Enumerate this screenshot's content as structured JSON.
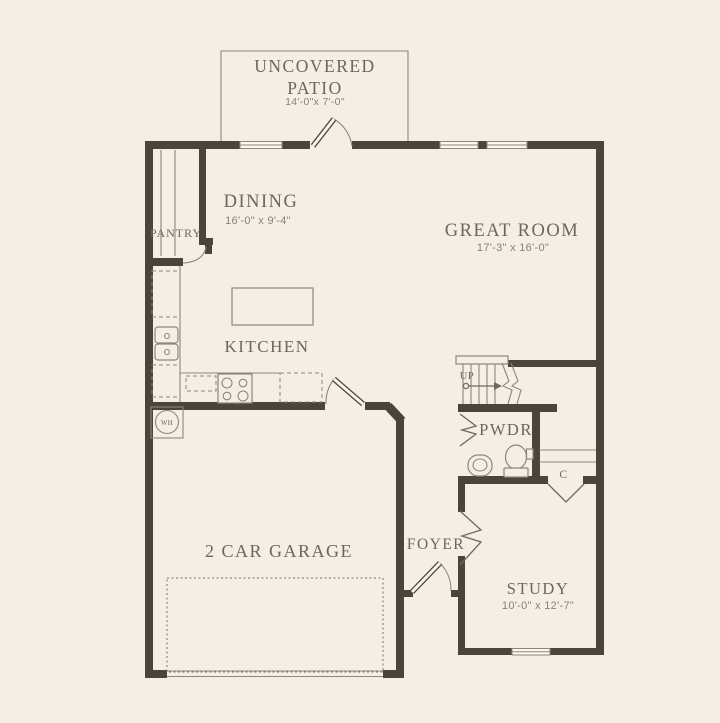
{
  "colors": {
    "background": "#f3efe6",
    "wall": "#4a443a",
    "thin_line": "#8e8678",
    "room_text": "#6e6659",
    "dimension_text": "#8a8173"
  },
  "rooms": {
    "patio": {
      "label_line1": "UNCOVERED",
      "label_line2": "PATIO",
      "dimensions": "14'-0\"x 7'-0\""
    },
    "dining": {
      "label": "DINING",
      "dimensions": "16'-0\" x 9'-4\""
    },
    "great_room": {
      "label": "GREAT ROOM",
      "dimensions": "17'-3\" x 16'-0\""
    },
    "kitchen": {
      "label": "KITCHEN"
    },
    "pantry": {
      "label": "PANTRY"
    },
    "powder_room": {
      "label": "PWDR"
    },
    "foyer": {
      "label": "FOYER"
    },
    "garage": {
      "label": "2 CAR GARAGE"
    },
    "study": {
      "label": "STUDY",
      "dimensions": "10'-0\" x 12'-7\""
    },
    "closet": {
      "label": "C"
    },
    "stairs": {
      "label": "UP"
    },
    "water_heater": {
      "label": "WH"
    }
  }
}
